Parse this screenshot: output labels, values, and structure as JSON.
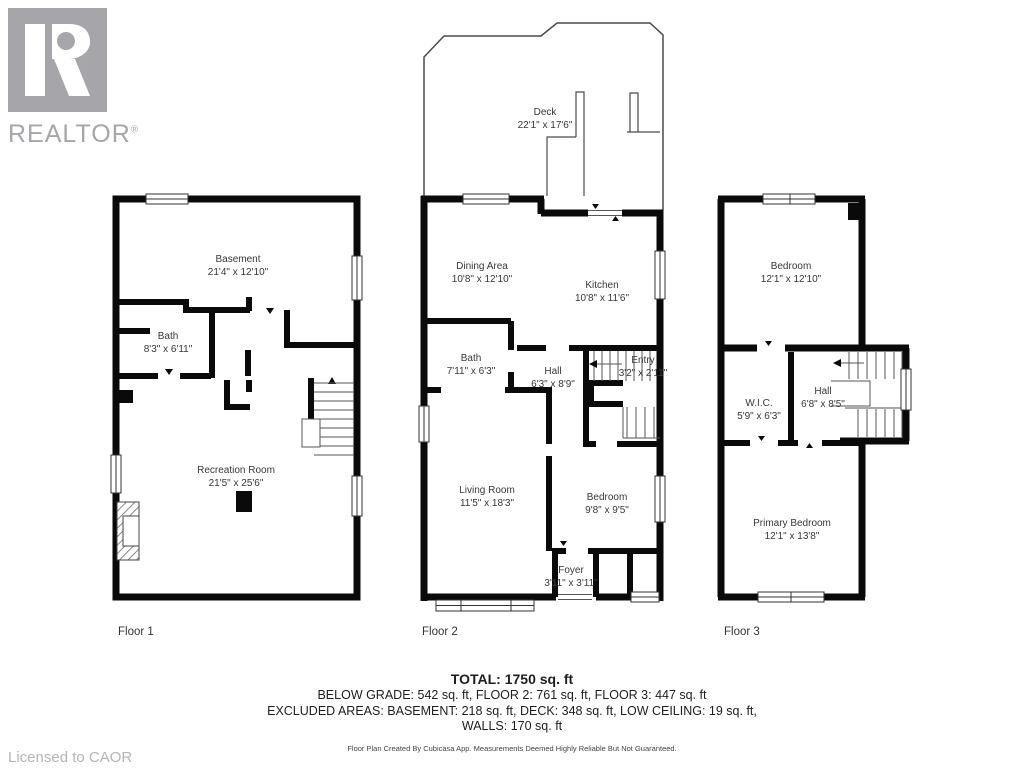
{
  "branding": {
    "logo_text": "REALTOR",
    "logo_reg_mark": "®",
    "logo_color": "#a6a6aa",
    "licensed_to": "Licensed to CAOR"
  },
  "floors": [
    {
      "label": "Floor 1",
      "rooms": [
        {
          "name": "Basement",
          "dims": "21'4\" x 12'10\""
        },
        {
          "name": "Bath",
          "dims": "8'3\" x 6'11\""
        },
        {
          "name": "Recreation Room",
          "dims": "21'5\" x 25'6\""
        }
      ]
    },
    {
      "label": "Floor 2",
      "rooms": [
        {
          "name": "Deck",
          "dims": "22'1\" x 17'6\""
        },
        {
          "name": "Dining Area",
          "dims": "10'8\" x 12'10\""
        },
        {
          "name": "Kitchen",
          "dims": "10'8\" x 11'6\""
        },
        {
          "name": "Bath",
          "dims": "7'11\" x 6'3\""
        },
        {
          "name": "Hall",
          "dims": "6'3\" x 8'9\""
        },
        {
          "name": "Entry",
          "dims": "3'2\" x 2'11\""
        },
        {
          "name": "Living Room",
          "dims": "11'5\" x 18'3\""
        },
        {
          "name": "Bedroom",
          "dims": "9'8\" x 9'5\""
        },
        {
          "name": "Foyer",
          "dims": "3'11\" x 3'11\""
        }
      ]
    },
    {
      "label": "Floor 3",
      "rooms": [
        {
          "name": "Bedroom",
          "dims": "12'1\" x 12'10\""
        },
        {
          "name": "W.I.C.",
          "dims": "5'9\" x 6'3\""
        },
        {
          "name": "Hall",
          "dims": "6'8\" x 8'5\""
        },
        {
          "name": "Primary Bedroom",
          "dims": "12'1\" x 13'8\""
        }
      ]
    }
  ],
  "summary": {
    "total": "TOTAL: 1750 sq. ft",
    "by_floor": "BELOW GRADE: 542 sq. ft, FLOOR 2: 761 sq. ft, FLOOR 3: 447 sq. ft",
    "excluded": "EXCLUDED AREAS: BASEMENT: 218 sq. ft, DECK: 348 sq. ft, LOW CEILING: 19 sq. ft,",
    "walls": "WALLS: 170 sq. ft",
    "disclaimer": "Floor Plan Created By Cubicasa App. Measurements Deemed Highly Reliable But Not Guaranteed."
  }
}
